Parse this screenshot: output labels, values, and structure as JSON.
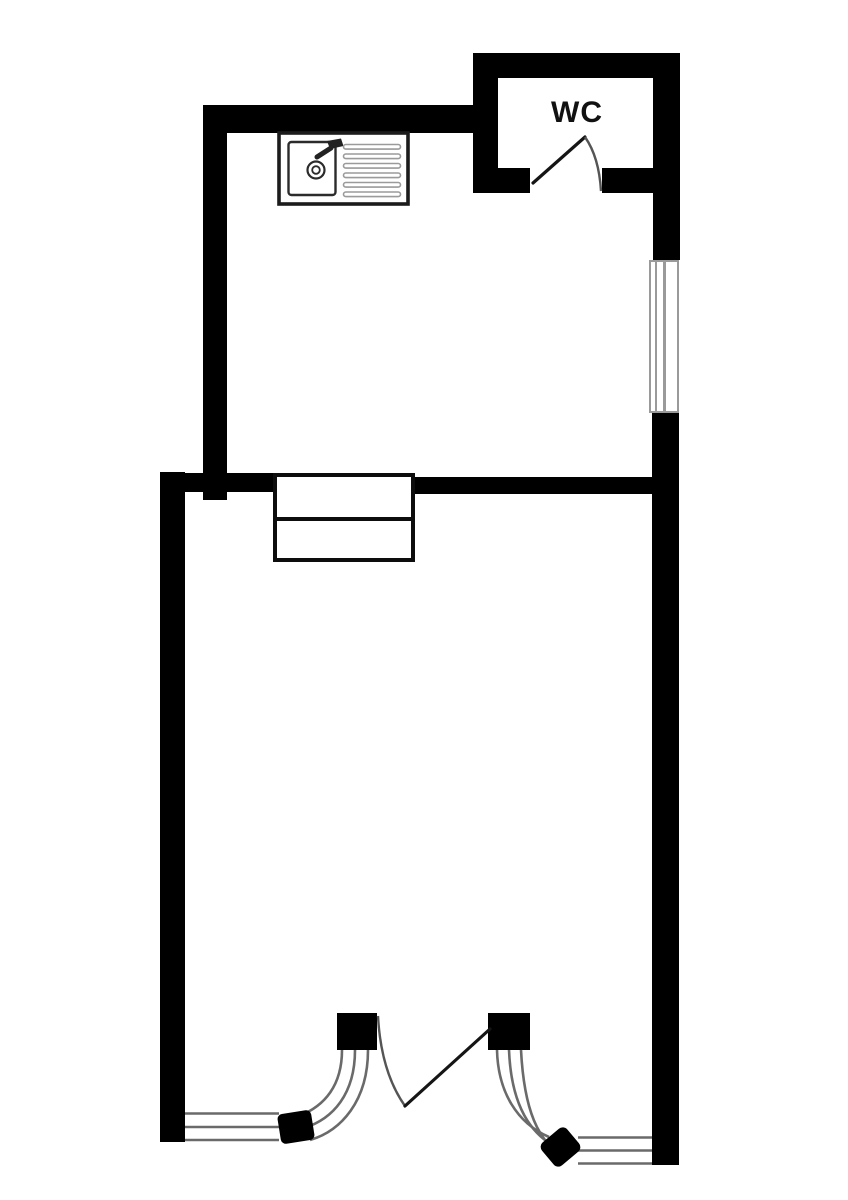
{
  "plan": {
    "label_wc": "WC",
    "colors": {
      "bg": "#ffffff",
      "wall": "#000000",
      "glazing-line": "#6a6a6a",
      "door-arc": "#555555",
      "fixture-outline": "#1b1b1b"
    },
    "fixtures": {
      "sink": "kitchen-sink",
      "window": "window",
      "wc_door": "wc-swing-door",
      "pass_through": "serving-hatch",
      "bottom_doors": "folding-glazed-doors"
    }
  }
}
